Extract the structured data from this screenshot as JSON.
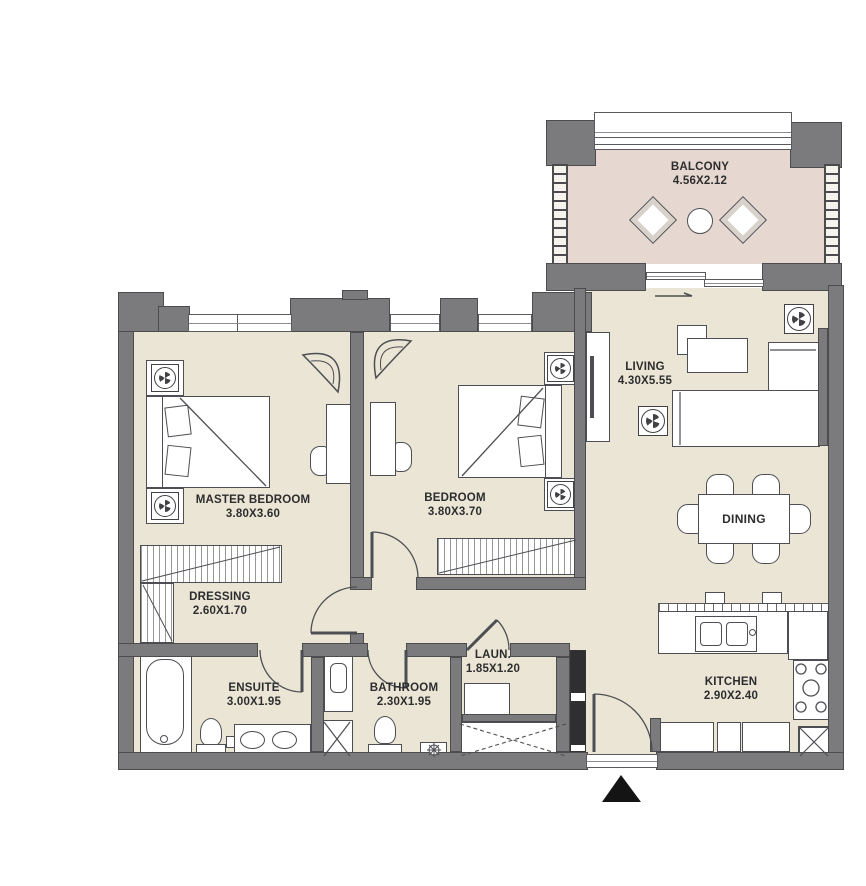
{
  "plan_title": "Apartment floor plan",
  "rooms": {
    "balcony": {
      "name": "BALCONY",
      "dims": "4.56X2.12"
    },
    "living": {
      "name": "LIVING",
      "dims": "4.30X5.55"
    },
    "master_bedroom": {
      "name": "MASTER BEDROOM",
      "dims": "3.80X3.60"
    },
    "bedroom": {
      "name": "BEDROOM",
      "dims": "3.80X3.70"
    },
    "dressing": {
      "name": "DRESSING",
      "dims": "2.60X1.70"
    },
    "ensuite": {
      "name": "ENSUITE",
      "dims": "3.00X1.95"
    },
    "bathroom": {
      "name": "BATHROOM",
      "dims": "2.30X1.95"
    },
    "laundry": {
      "name": "LAUN.",
      "dims": "1.85X1.20"
    },
    "dining": {
      "name": "DINING",
      "dims": ""
    },
    "kitchen": {
      "name": "KITCHEN",
      "dims": "2.90X2.40"
    }
  },
  "colors": {
    "wall": "#7b7a7c",
    "floor": "#eae5d4",
    "balcony_floor": "#e6d8d0",
    "line": "#4d4e53",
    "text": "#2d2d2f",
    "entry": "#141414"
  }
}
